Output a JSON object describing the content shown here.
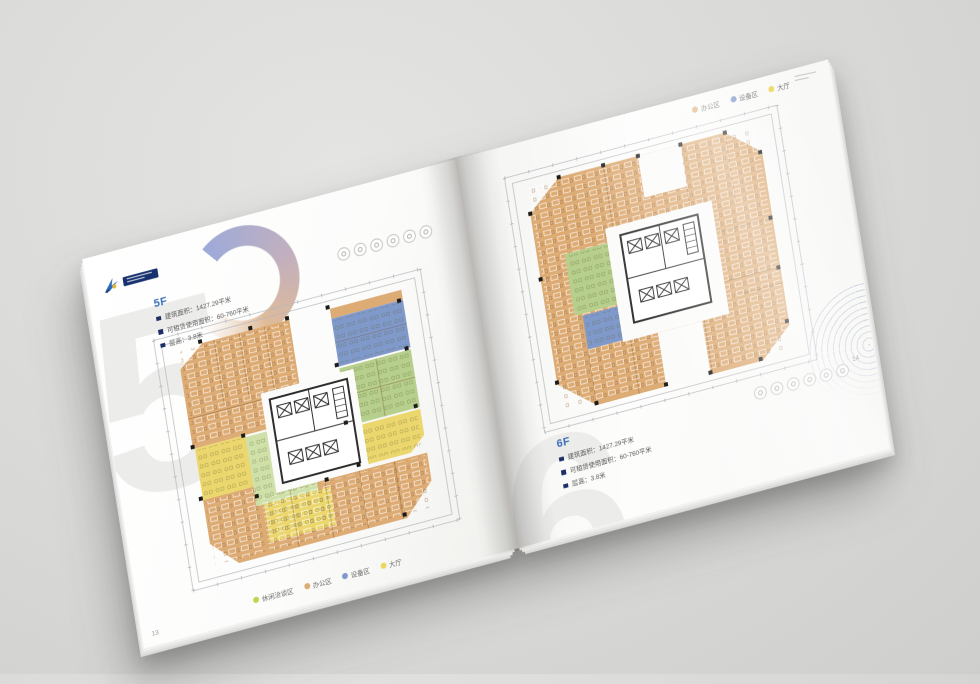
{
  "colors": {
    "page": "#fbfbfa",
    "accent_blue": "#3a6fba",
    "bullet_navy": "#1e2f66",
    "text_gray": "#5a5a5a",
    "dim_line": "#b4b8bd",
    "core_line": "#2e2e2e",
    "zone_orange": "#ddab74",
    "zone_blue": "#8099cb",
    "zone_green": "#b6cf8c",
    "zone_green_light": "#cfe0a8",
    "zone_yellow": "#ecd76e",
    "watermark": "#ececea",
    "logo_navy": "#17306e",
    "logo_blue": "#2b6cb8",
    "logo_yellow": "#e8b53a"
  },
  "page_left": {
    "page_number": "13",
    "watermark_digit": "5",
    "floor_label": "5F",
    "stats": [
      "建筑面积：1427.29平米",
      "可租赁使用面积：60-760平米",
      "层高：3.8米"
    ],
    "legend": [
      {
        "label": "休闲洽谈区",
        "color": "#c6d24e"
      },
      {
        "label": "办公区",
        "color": "#ddab74"
      },
      {
        "label": "设备区",
        "color": "#8099cb"
      },
      {
        "label": "大厅",
        "color": "#ecd75e"
      }
    ],
    "amenity_icon_count": 6
  },
  "page_right": {
    "page_number": "14",
    "watermark_digit": "6",
    "floor_label": "6F",
    "stats": [
      "建筑面积：1427.29平米",
      "可租赁使用面积：60-760平米",
      "层高：3.8米"
    ],
    "legend": [
      {
        "label": "办公区",
        "color": "#ddab74"
      },
      {
        "label": "设备区",
        "color": "#8099cb"
      },
      {
        "label": "大厅",
        "color": "#ecd75e"
      }
    ],
    "amenity_icon_count": 6
  }
}
